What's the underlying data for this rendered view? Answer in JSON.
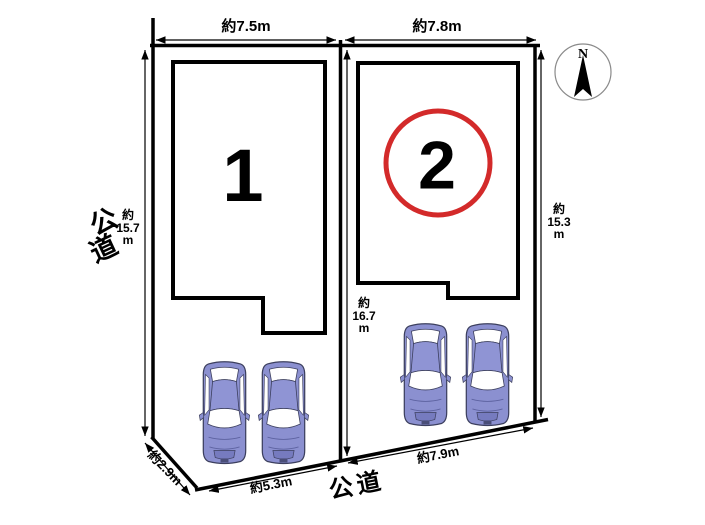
{
  "compass": {
    "north_label": "N"
  },
  "roads": {
    "left_label": "公道",
    "left_label_chars": [
      "公",
      "道"
    ],
    "bottom_label": "公道"
  },
  "lots": {
    "lot1_number": "1",
    "lot2_number": "2"
  },
  "dimensions": {
    "lot1_frontage_top": "約7.5m",
    "lot2_frontage_top": "約7.8m",
    "left_depth": "約\n15.7\nm",
    "right_depth": "約\n15.3\nm",
    "center_depth": "約\n16.7\nm",
    "bottom_left_diagonal": "約2.9m",
    "lot1_frontage_bottom": "約5.3m",
    "lot2_frontage_bottom": "約7.9m"
  },
  "colors": {
    "lot2_circle": "#d32a2a",
    "car_body": "#8b90d0",
    "car_window": "#ffffff",
    "outline": "#000000"
  }
}
